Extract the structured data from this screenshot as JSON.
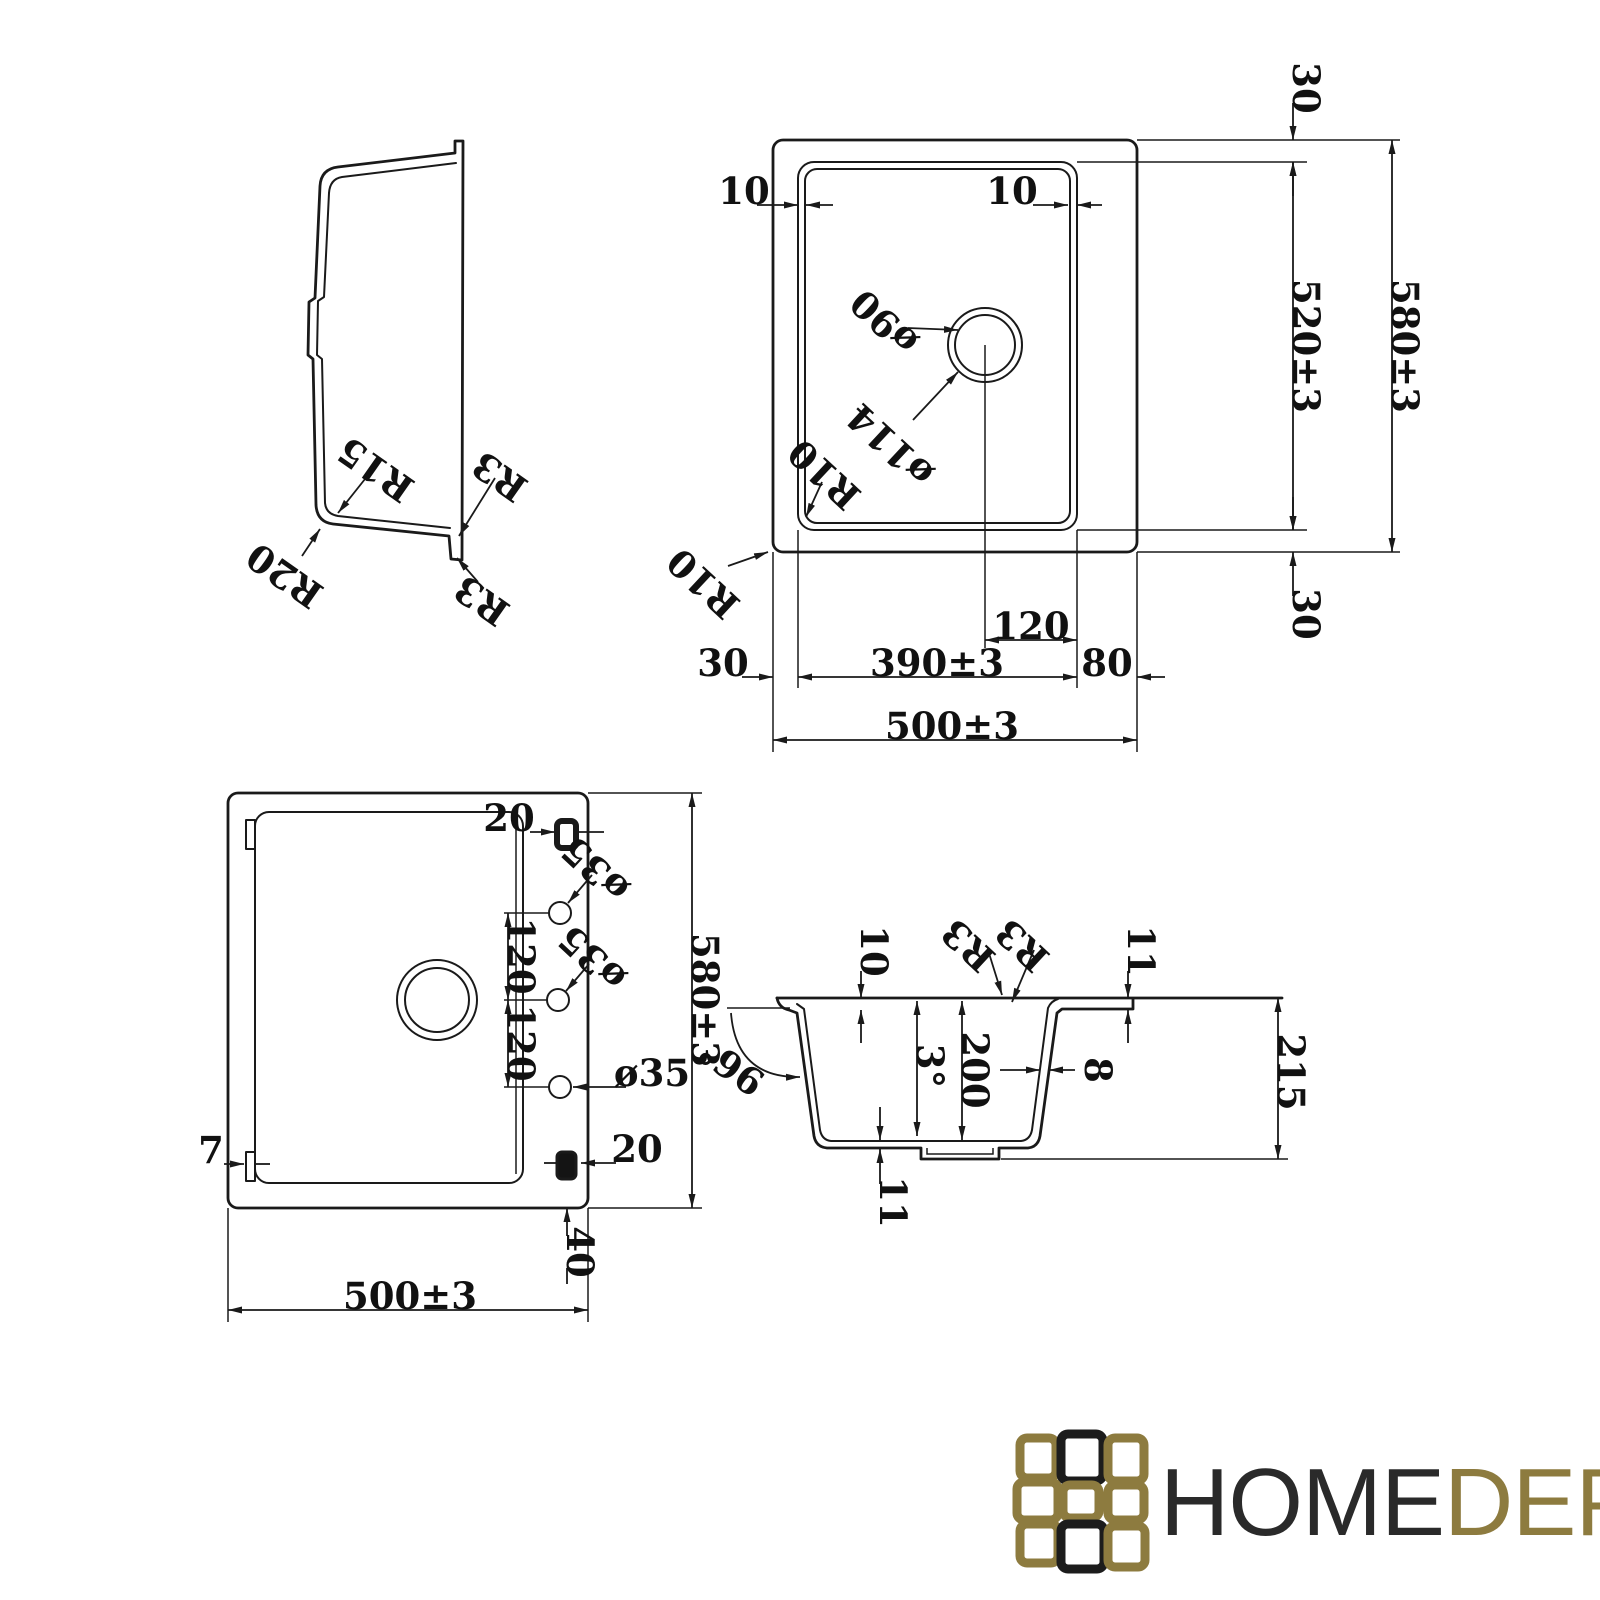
{
  "views": {
    "side": {
      "r15": "R15",
      "r20": "R20",
      "r3_upper": "R3",
      "r3_lower": "R3"
    },
    "top": {
      "off_top": "30",
      "lip_left": "10",
      "lip_right": "10",
      "drain_d_inner": "ø90",
      "drain_d_outer": "ø114",
      "r10_bowl": "R10",
      "r10_outer": "R10",
      "bowl_len": "520±3",
      "overall_len": "580±3",
      "off_bottom": "30",
      "drain_off": "120",
      "bowl_w": "390±3",
      "off_right": "80",
      "off_left": "30",
      "overall_w": "500±3"
    },
    "bottom": {
      "slot_top": "20",
      "hole_top": "ø35",
      "hole_mid": "ø35",
      "hole_bot": "ø35",
      "pitch_a": "120",
      "pitch_b": "120",
      "overall_len": "580±3",
      "slot_bottom": "20",
      "tab_w": "7",
      "foot_off": "40",
      "overall_w": "500±3"
    },
    "section": {
      "rim_inset": "10",
      "r3_a": "R3",
      "r3_b": "R3",
      "edge_thk": "11",
      "outer_angle": "96°",
      "draft_angle": "3°",
      "bowl_depth": "200",
      "wall_thk": "8",
      "total_depth": "215",
      "bottom_thk": "11"
    }
  },
  "logo": {
    "word_primary": "HOME",
    "word_secondary": "DEPO"
  },
  "colors": {
    "line": "#1a1a1a",
    "logo_gold": "#8d7b3f",
    "logo_black": "#1c1c1c"
  }
}
